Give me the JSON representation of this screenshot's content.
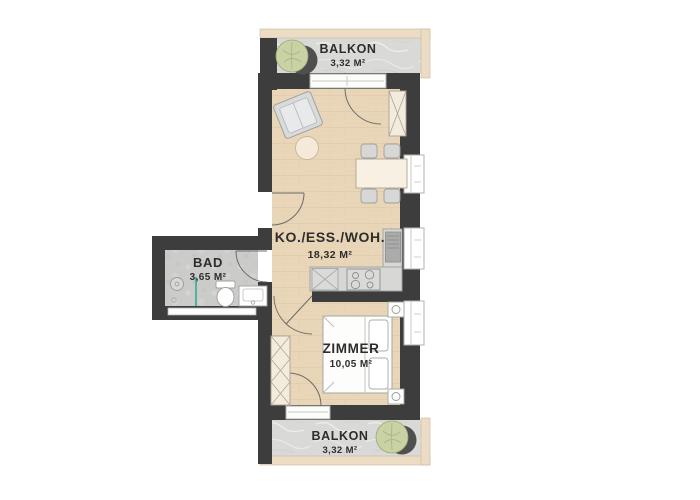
{
  "rooms": [
    {
      "name": "balcony-top",
      "label": "BALKON",
      "area": "3,32 M²"
    },
    {
      "name": "living-dining-kitchen",
      "label": "KO./ESS./WOH.",
      "area": "18,32 M²"
    },
    {
      "name": "bathroom",
      "label": "BAD",
      "area": "3,65 M²"
    },
    {
      "name": "bedroom",
      "label": "ZIMMER",
      "area": "10,05 M²"
    },
    {
      "name": "balcony-bottom",
      "label": "BALKON",
      "area": "3,32 M²"
    }
  ],
  "colors": {
    "wall": "#3d3d3d",
    "wood_floor": "#e9d6b8",
    "wood_grain": "#d9c09c",
    "balcony_floor": "#d9d9d7",
    "bath_floor": "#cbcbc9",
    "trim": "#ecdcc4",
    "counter": "#d7d7d5",
    "furniture_fill": "#fdfdfc",
    "furniture_stroke": "#a3a3a1",
    "sofa_fill": "#d9dadc",
    "plant": "#c9d2a2",
    "plant_shadow": "#4f4f4d",
    "glass_divider": "#4fb3a4",
    "label_text": "#2d2d2d"
  }
}
